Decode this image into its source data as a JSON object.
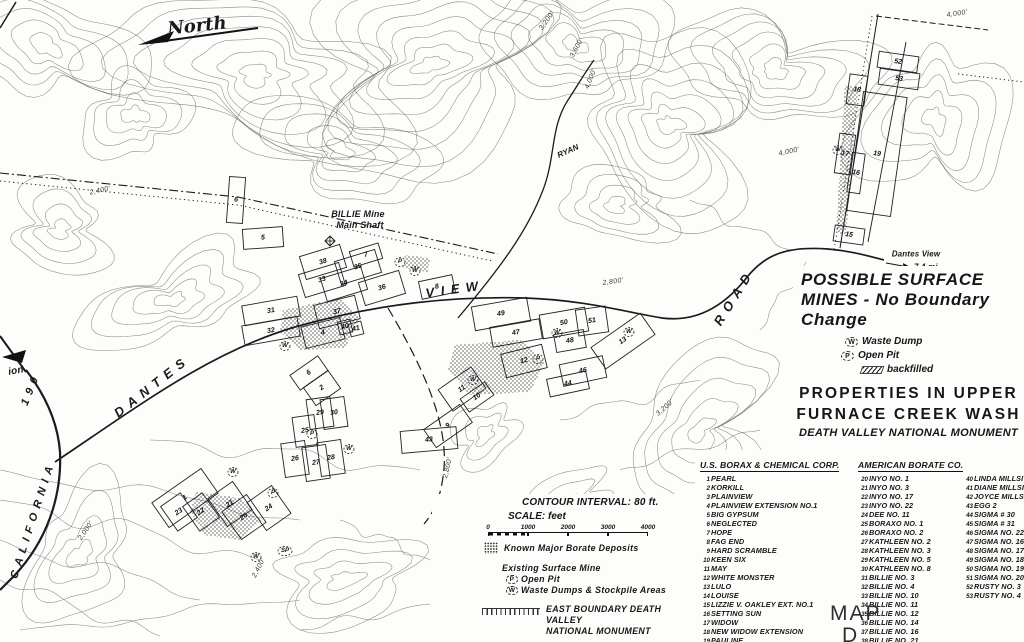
{
  "north_label": "North",
  "title_block": {
    "line1": "POSSIBLE  SURFACE",
    "line2": "MINES - No  Boundary",
    "line3": "Change",
    "legend": [
      {
        "symbol": "W",
        "label": "Waste Dump"
      },
      {
        "symbol": "P",
        "label": "Open Pit"
      },
      {
        "symbol": "hatch",
        "label": "backfilled"
      }
    ],
    "subtitle1": "PROPERTIES  IN  UPPER",
    "subtitle2": "FURNACE  CREEK  WASH",
    "subtitle3": "DEATH VALLEY NATIONAL MONUMENT"
  },
  "scale_block": {
    "contour_interval": "CONTOUR INTERVAL: 80 ft.",
    "scale_label": "SCALE:  feet",
    "ticks": [
      "0",
      "1000",
      "2000",
      "3000",
      "4000"
    ]
  },
  "map_legend": {
    "borate": "Known Major Borate Deposits",
    "existing": "Existing Surface Mine",
    "open_pit_symbol": "P",
    "open_pit": "Open Pit",
    "waste_symbol": "W",
    "waste": "Waste Dumps & Stockpile Areas",
    "boundary1": "EAST  BOUNDARY  DEATH  VALLEY",
    "boundary2": "NATIONAL  MONUMENT"
  },
  "map_sheet": {
    "line1": "MAP",
    "line2": "D"
  },
  "companies": [
    {
      "name": "U.S. BORAX & CHEMICAL CORP.",
      "claims": [
        {
          "num": "1",
          "name": "PEARL"
        },
        {
          "num": "2",
          "name": "KORKILL"
        },
        {
          "num": "3",
          "name": "PLAINVIEW"
        },
        {
          "num": "4",
          "name": "PLAINVIEW EXTENSION NO.1"
        },
        {
          "num": "5",
          "name": "BIG GYPSUM"
        },
        {
          "num": "6",
          "name": "NEGLECTED"
        },
        {
          "num": "7",
          "name": "HOPE"
        },
        {
          "num": "8",
          "name": "FAG END"
        },
        {
          "num": "9",
          "name": "HARD SCRAMBLE"
        },
        {
          "num": "10",
          "name": "KEEN SIX"
        },
        {
          "num": "11",
          "name": "MAY"
        },
        {
          "num": "12",
          "name": "WHITE MONSTER"
        },
        {
          "num": "13",
          "name": "LULO"
        },
        {
          "num": "14",
          "name": "LOUISE"
        },
        {
          "num": "15",
          "name": "LIZZIE V. OAKLEY EXT. NO.1"
        },
        {
          "num": "16",
          "name": "SETTING SUN"
        },
        {
          "num": "17",
          "name": "WIDOW"
        },
        {
          "num": "18",
          "name": "NEW WIDOW EXTENSION"
        },
        {
          "num": "19",
          "name": "PAULINE"
        },
        {
          "num": "SP",
          "name": "STATE PATENT"
        }
      ]
    },
    {
      "name": "AMERICAN BORATE CO.",
      "claims_a": [
        {
          "num": "20",
          "name": "INYO NO. 1"
        },
        {
          "num": "21",
          "name": "INYO NO. 3"
        },
        {
          "num": "22",
          "name": "INYO NO. 17"
        },
        {
          "num": "23",
          "name": "INYO NO. 22"
        },
        {
          "num": "24",
          "name": "DEE NO. 11"
        },
        {
          "num": "25",
          "name": "BORAXO NO. 1"
        },
        {
          "num": "26",
          "name": "BORAXO NO. 2"
        },
        {
          "num": "27",
          "name": "KATHLEEN NO. 2"
        },
        {
          "num": "28",
          "name": "KATHLEEN NO. 3"
        },
        {
          "num": "29",
          "name": "KATHLEEN NO. 5"
        },
        {
          "num": "30",
          "name": "KATHLEEN NO. 8"
        },
        {
          "num": "31",
          "name": "BILLIE NO. 3"
        },
        {
          "num": "32",
          "name": "BILLIE NO. 4"
        },
        {
          "num": "33",
          "name": "BILLIE NO. 10"
        },
        {
          "num": "34",
          "name": "BILLIE NO. 11"
        },
        {
          "num": "35",
          "name": "BILLIE NO. 12"
        },
        {
          "num": "36",
          "name": "BILLIE NO. 14"
        },
        {
          "num": "37",
          "name": "BILLIE NO. 16"
        },
        {
          "num": "38",
          "name": "BILLIE NO. 21"
        },
        {
          "num": "39",
          "name": "BILLIE NO. 22"
        }
      ],
      "claims_b": [
        {
          "num": "40",
          "name": "LINDA MILLSITE"
        },
        {
          "num": "41",
          "name": "DIANE MILLSITE"
        },
        {
          "num": "42",
          "name": "JOYCE MILLSITE"
        },
        {
          "num": "43",
          "name": "EGG 2"
        },
        {
          "num": "44",
          "name": "SIGMA # 30"
        },
        {
          "num": "45",
          "name": "SIGMA # 31"
        },
        {
          "num": "46",
          "name": "SIGMA NO. 22"
        },
        {
          "num": "47",
          "name": "SIGMA NO. 16"
        },
        {
          "num": "48",
          "name": "SIGMA NO. 17"
        },
        {
          "num": "49",
          "name": "SIGMA NO. 18"
        },
        {
          "num": "50",
          "name": "SIGMA NO. 19"
        },
        {
          "num": "51",
          "name": "SIGMA NO. 20"
        },
        {
          "num": "52",
          "name": "RUSTY NO. 3"
        },
        {
          "num": "53",
          "name": "RUSTY NO. 4"
        }
      ]
    }
  ],
  "map_labels": [
    {
      "name": "north-label",
      "t": "North",
      "x": 197,
      "y": 26,
      "r": -6,
      "s": 18,
      "cls": "script"
    },
    {
      "name": "road-label-dantes",
      "t": "DANTES",
      "x": 152,
      "y": 386,
      "r": -38,
      "s": 13,
      "cls": "lr"
    },
    {
      "name": "road-label-view",
      "t": "VIEW",
      "x": 455,
      "y": 289,
      "r": -8,
      "s": 13,
      "cls": "lr"
    },
    {
      "name": "road-label-road",
      "t": "ROAD",
      "x": 734,
      "y": 297,
      "r": -58,
      "s": 13,
      "cls": "lr"
    },
    {
      "name": "road-label-california",
      "t": "CALIFORNIA",
      "x": 33,
      "y": 520,
      "r": -72,
      "s": 11,
      "cls": "lr"
    },
    {
      "name": "road-label-190",
      "t": "190",
      "x": 31,
      "y": 389,
      "r": -68,
      "s": 11,
      "cls": "lr"
    },
    {
      "name": "place-label-ryan",
      "t": "RYAN",
      "x": 568,
      "y": 151,
      "r": -24,
      "s": 8,
      "cls": "sm"
    },
    {
      "name": "billie-mine-label",
      "t": "BILLIE Mine",
      "x": 358,
      "y": 214,
      "r": 0,
      "s": 9,
      "cls": "sm"
    },
    {
      "name": "billie-mine-shaft-label",
      "t": "Main Shaft",
      "x": 360,
      "y": 225,
      "r": 0,
      "s": 9,
      "cls": "sm"
    },
    {
      "name": "dantes-view-label",
      "t": "Dantes View",
      "x": 916,
      "y": 254,
      "r": 0,
      "s": 8,
      "cls": "sm"
    },
    {
      "name": "dantes-view-distance",
      "t": "7.4 mi.",
      "x": 927,
      "y": 267,
      "r": 0,
      "s": 8,
      "cls": "sm"
    },
    {
      "name": "cutoff-label",
      "t": "ion",
      "x": 16,
      "y": 371,
      "r": -10,
      "s": 10,
      "cls": "sm"
    },
    {
      "name": "elevation-label",
      "t": "2,400'",
      "x": 100,
      "y": 191,
      "r": -12,
      "s": 7,
      "cls": "elev"
    },
    {
      "name": "elevation-label",
      "t": "3,200'",
      "x": 547,
      "y": 21,
      "r": -55,
      "s": 7,
      "cls": "elev"
    },
    {
      "name": "elevation-label",
      "t": "3,600'",
      "x": 577,
      "y": 48,
      "r": -62,
      "s": 7,
      "cls": "elev"
    },
    {
      "name": "elevation-label",
      "t": "4,000'",
      "x": 591,
      "y": 79,
      "r": -68,
      "s": 7,
      "cls": "elev"
    },
    {
      "name": "elevation-label",
      "t": "4,000'",
      "x": 789,
      "y": 152,
      "r": -12,
      "s": 7,
      "cls": "elev"
    },
    {
      "name": "elevation-label",
      "t": "4,000'",
      "x": 957,
      "y": 14,
      "r": -8,
      "s": 7,
      "cls": "elev"
    },
    {
      "name": "elevation-label",
      "t": "2,800'",
      "x": 613,
      "y": 282,
      "r": -8,
      "s": 7,
      "cls": "elev"
    },
    {
      "name": "elevation-label",
      "t": "2,800'",
      "x": 448,
      "y": 468,
      "r": -76,
      "s": 7,
      "cls": "elev"
    },
    {
      "name": "elevation-label",
      "t": "3,200'",
      "x": 665,
      "y": 408,
      "r": -42,
      "s": 7,
      "cls": "elev"
    },
    {
      "name": "elevation-label",
      "t": "2,000'",
      "x": 86,
      "y": 531,
      "r": -56,
      "s": 7,
      "cls": "elev"
    },
    {
      "name": "elevation-label",
      "t": "2,400'",
      "x": 259,
      "y": 568,
      "r": -63,
      "s": 7,
      "cls": "elev"
    }
  ],
  "parcels": [
    {
      "n": "5",
      "x": 263,
      "y": 238,
      "r": -4,
      "w": 40,
      "h": 20
    },
    {
      "n": "6",
      "x": 236,
      "y": 200,
      "r": 4,
      "w": 16,
      "h": 46
    },
    {
      "n": "38",
      "x": 323,
      "y": 262,
      "r": -17
    },
    {
      "n": "35",
      "x": 358,
      "y": 267,
      "r": -17
    },
    {
      "n": "7",
      "x": 366,
      "y": 255,
      "r": -17,
      "w": 30,
      "h": 16
    },
    {
      "n": "33",
      "x": 322,
      "y": 280,
      "r": -17
    },
    {
      "n": "34",
      "x": 344,
      "y": 284,
      "r": -17
    },
    {
      "n": "36",
      "x": 382,
      "y": 288,
      "r": -17
    },
    {
      "n": "8",
      "x": 437,
      "y": 287,
      "r": -12,
      "w": 34,
      "h": 18
    },
    {
      "n": "31",
      "x": 271,
      "y": 311,
      "r": -10,
      "w": 56,
      "h": 20
    },
    {
      "n": "32",
      "x": 271,
      "y": 331,
      "r": -10,
      "w": 56,
      "h": 20
    },
    {
      "n": "37",
      "x": 337,
      "y": 312,
      "r": -14
    },
    {
      "n": "4",
      "x": 323,
      "y": 333,
      "r": -14,
      "w": 40,
      "h": 22
    },
    {
      "n": "40",
      "x": 345,
      "y": 327,
      "r": -14,
      "w": 13,
      "h": 13
    },
    {
      "n": "41",
      "x": 356,
      "y": 329,
      "r": -14,
      "w": 13,
      "h": 13
    },
    {
      "n": "49",
      "x": 501,
      "y": 314,
      "r": -10,
      "w": 56,
      "h": 24
    },
    {
      "n": "50",
      "x": 564,
      "y": 323,
      "r": -10,
      "w": 46,
      "h": 24
    },
    {
      "n": "51",
      "x": 592,
      "y": 321,
      "r": -8,
      "w": 30,
      "h": 26
    },
    {
      "n": "47",
      "x": 516,
      "y": 333,
      "r": -10,
      "w": 50,
      "h": 20
    },
    {
      "n": "48",
      "x": 570,
      "y": 341,
      "r": -10,
      "w": 30,
      "h": 18
    },
    {
      "n": "13",
      "x": 623,
      "y": 341,
      "r": -35,
      "w": 60,
      "h": 26
    },
    {
      "n": "12",
      "x": 524,
      "y": 361,
      "r": -14
    },
    {
      "n": "46",
      "x": 583,
      "y": 371,
      "r": -12,
      "w": 44,
      "h": 22
    },
    {
      "n": "44",
      "x": 568,
      "y": 384,
      "r": -12,
      "w": 40,
      "h": 18
    },
    {
      "n": "11",
      "x": 462,
      "y": 389,
      "r": -35,
      "w": 40,
      "h": 26
    },
    {
      "n": "10",
      "x": 477,
      "y": 397,
      "r": -35,
      "w": 30,
      "h": 16
    },
    {
      "n": "6",
      "x": 309,
      "y": 373,
      "r": -35,
      "w": 34,
      "h": 18
    },
    {
      "n": "2",
      "x": 322,
      "y": 388,
      "r": -35,
      "w": 30,
      "h": 22
    },
    {
      "n": "29",
      "x": 320,
      "y": 413,
      "r": -8,
      "w": 24,
      "h": 30
    },
    {
      "n": "30",
      "x": 334,
      "y": 413,
      "r": -8,
      "w": 24,
      "h": 30
    },
    {
      "n": "25",
      "x": 305,
      "y": 431,
      "r": -8,
      "w": 22,
      "h": 30
    },
    {
      "n": "26",
      "x": 295,
      "y": 459,
      "r": -8,
      "w": 24,
      "h": 34
    },
    {
      "n": "27",
      "x": 316,
      "y": 463,
      "r": -8,
      "w": 24,
      "h": 34
    },
    {
      "n": "28",
      "x": 331,
      "y": 458,
      "r": -8,
      "w": 24,
      "h": 34
    },
    {
      "n": "9",
      "x": 448,
      "y": 426,
      "r": -35,
      "w": 44,
      "h": 22
    },
    {
      "n": "43",
      "x": 429,
      "y": 440,
      "r": -5,
      "w": 56,
      "h": 22
    },
    {
      "n": "1",
      "x": 185,
      "y": 498,
      "r": -35,
      "w": 60,
      "h": 30
    },
    {
      "n": "23",
      "x": 179,
      "y": 512,
      "r": -35,
      "w": 24,
      "h": 30
    },
    {
      "n": "22",
      "x": 201,
      "y": 512,
      "r": -35,
      "w": 24,
      "h": 30
    },
    {
      "n": "21",
      "x": 230,
      "y": 504,
      "r": -35,
      "w": 30,
      "h": 34
    },
    {
      "n": "20",
      "x": 244,
      "y": 517,
      "r": -35,
      "w": 30,
      "h": 34
    },
    {
      "n": "24",
      "x": 269,
      "y": 508,
      "r": -35,
      "w": 30,
      "h": 34
    },
    {
      "n": "52",
      "x": 898,
      "y": 62,
      "r": 8,
      "w": 40,
      "h": 16
    },
    {
      "n": "53",
      "x": 899,
      "y": 79,
      "r": 8,
      "w": 40,
      "h": 16
    },
    {
      "n": "18",
      "x": 857,
      "y": 90,
      "r": 8,
      "w": 18,
      "h": 30
    },
    {
      "n": "17",
      "x": 845,
      "y": 154,
      "r": 8,
      "w": 16,
      "h": 40
    },
    {
      "n": "19",
      "x": 877,
      "y": 154,
      "r": 8,
      "w": 44,
      "h": 120
    },
    {
      "n": "16",
      "x": 856,
      "y": 173,
      "r": 8,
      "w": 13,
      "h": 40
    },
    {
      "n": "15",
      "x": 849,
      "y": 235,
      "r": 8,
      "w": 30,
      "h": 16
    }
  ],
  "markers": [
    {
      "m": "W",
      "x": 415,
      "y": 271
    },
    {
      "m": "P",
      "x": 400,
      "y": 262
    },
    {
      "m": "W",
      "x": 285,
      "y": 346
    },
    {
      "m": "W",
      "x": 557,
      "y": 333
    },
    {
      "m": "W",
      "x": 629,
      "y": 332
    },
    {
      "m": "W",
      "x": 473,
      "y": 380
    },
    {
      "m": "P",
      "x": 538,
      "y": 359
    },
    {
      "m": "W",
      "x": 349,
      "y": 449
    },
    {
      "m": "P",
      "x": 312,
      "y": 434
    },
    {
      "m": "W",
      "x": 233,
      "y": 472
    },
    {
      "m": "W",
      "x": 256,
      "y": 557
    },
    {
      "m": "SP",
      "x": 285,
      "y": 551
    },
    {
      "m": "P",
      "x": 273,
      "y": 493
    },
    {
      "m": "W",
      "x": 838,
      "y": 150
    }
  ]
}
